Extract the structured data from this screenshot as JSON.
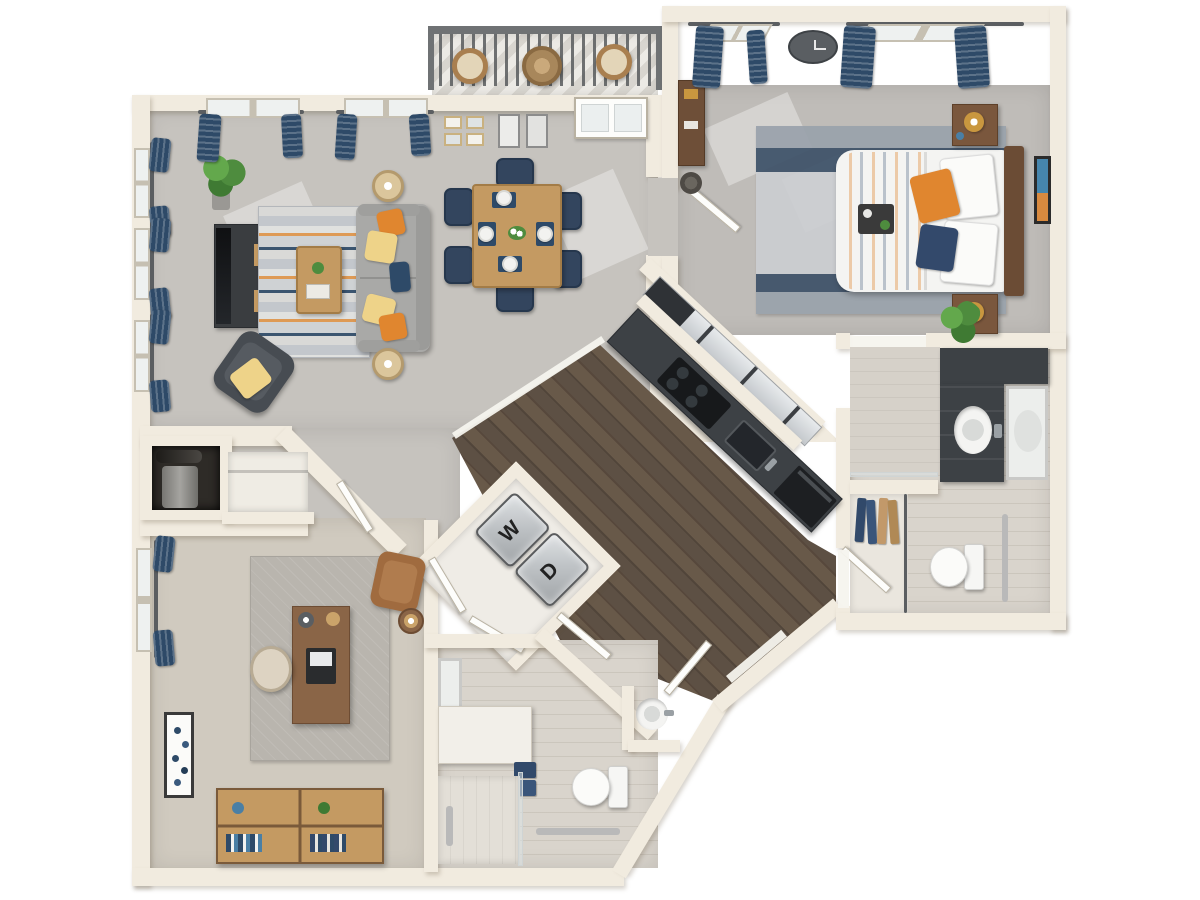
{
  "labels": {
    "washer": "W",
    "dryer": "D"
  },
  "theme": {
    "bg": "#ffffff",
    "wall": "#f1ebdf",
    "wall_edge": "#ddd3bf",
    "carpet": "#c6c3be",
    "carpet_bed": "#bfbcb8",
    "carpet_office": "#d0cabf",
    "wood": "#5d5044",
    "tile": "#d9d4cc",
    "tile_light": "#e0dcd4",
    "counter": "#3d4145",
    "navy": "#2e4a68",
    "orange": "#e0862f",
    "yellow": "#eed389",
    "sofa": "#a9a9a7",
    "wood_furn": "#c49a62",
    "wood_furn_dark": "#8a6547",
    "railing": "#6f7274",
    "green": "#4e8c3e",
    "door": "#fdfdfb",
    "metal": "#b9b9b9"
  }
}
